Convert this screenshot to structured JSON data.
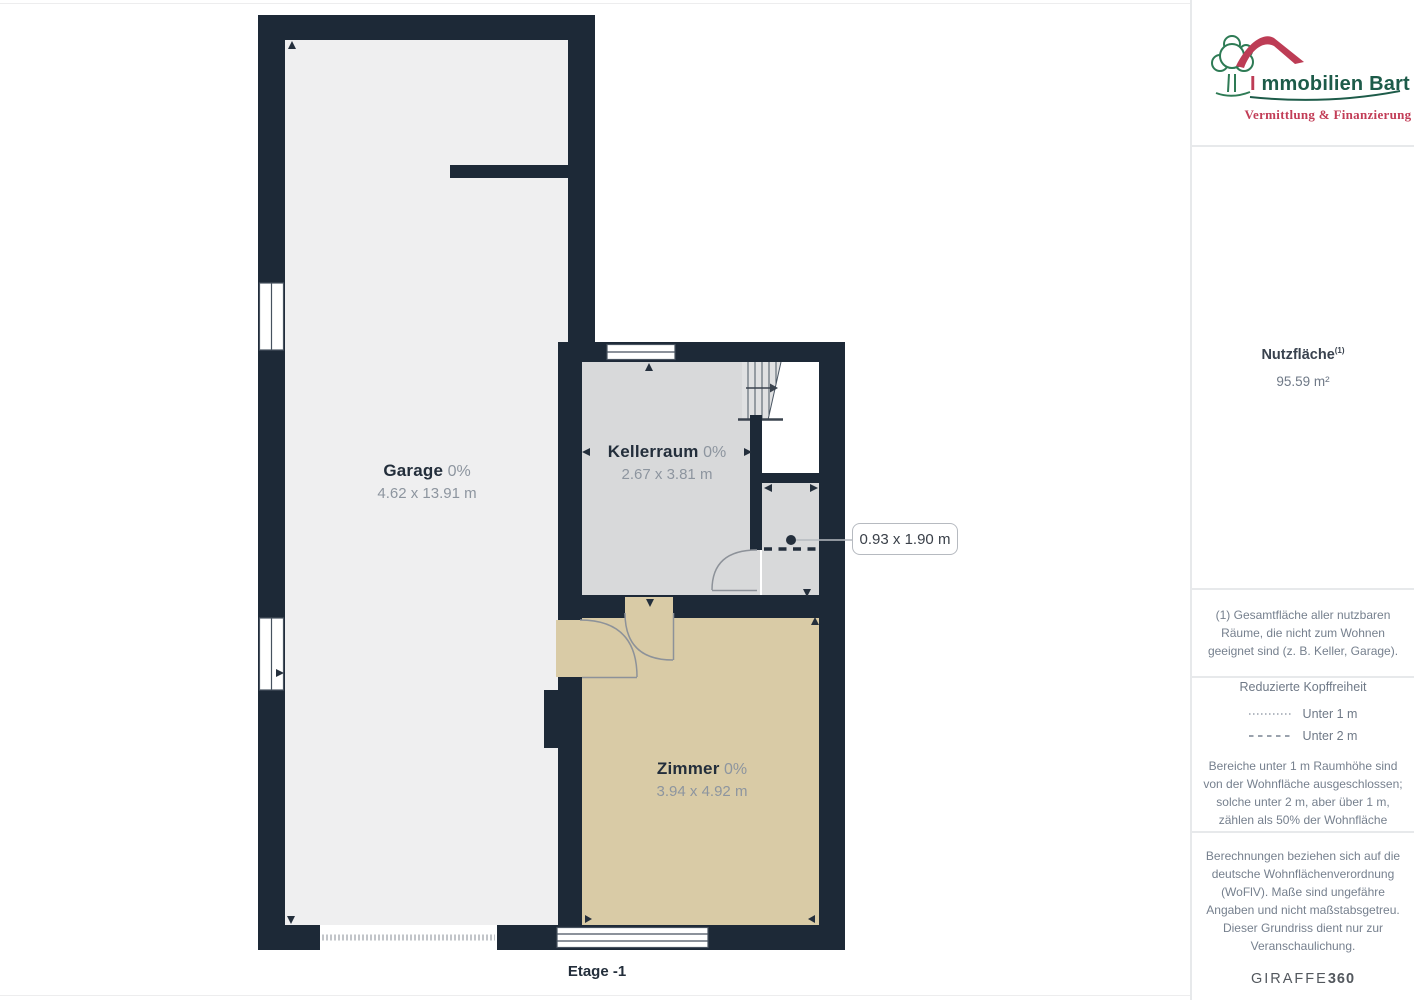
{
  "plan": {
    "floor_label": "Etage -1",
    "rooms": [
      {
        "name": "Garage",
        "pct": "0%",
        "dims": "4.62 x 13.91 m"
      },
      {
        "name": "Kellerraum",
        "pct": "0%",
        "dims": "2.67 x 3.81 m"
      },
      {
        "name": "Zimmer",
        "pct": "0%",
        "dims": "3.94 x 4.92 m"
      }
    ],
    "callout": "0.93 x 1.90 m",
    "colors": {
      "wall": "#1d2937",
      "garage_floor": "#efeff0",
      "keller_floor": "#d8d9da",
      "zimmer_floor": "#d9cba6"
    }
  },
  "sidebar": {
    "logo": {
      "title_i": "I",
      "title_rest": "mmobilien Bart",
      "tagline": "Vermittlung & Finanzierung",
      "green": "#1d5b49",
      "red": "#bd3c55"
    },
    "area": {
      "label": "Nutzfläche",
      "sup": "(1)",
      "value": "95.59 m²"
    },
    "footnote": "(1) Gesamtfläche aller nutzbaren Räume, die nicht zum Wohnen geeignet sind (z. B. Keller, Garage).",
    "headroom": {
      "title": "Reduzierte Kopffreiheit",
      "legend_under_1m": "Unter 1 m",
      "legend_under_2m": "Unter 2 m",
      "text": "Bereiche unter 1 m Raumhöhe sind von der Wohnfläche ausgeschlossen; solche unter 2 m, aber über 1 m, zählen als 50% der Wohnfläche"
    },
    "disclaimer": "Berechnungen beziehen sich auf die deutsche Wohnflächenverordnung (WoFlV). Maße sind ungefähre Angaben und nicht maßstabsgetreu. Dieser Grundriss dient nur zur Veranschaulichung.",
    "brand": {
      "giraffe": "GIRAFFE",
      "n360": "360"
    }
  }
}
